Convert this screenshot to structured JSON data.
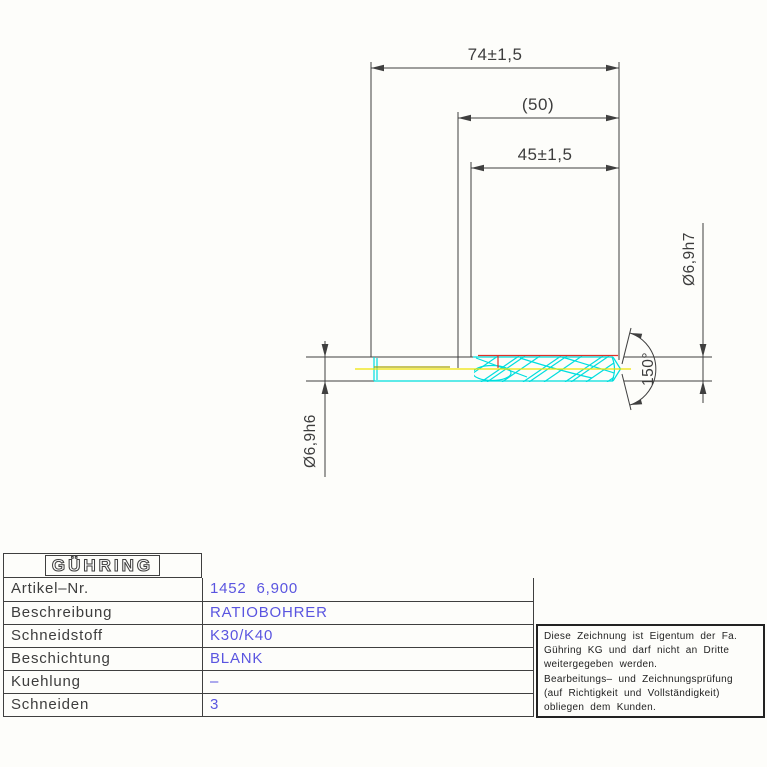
{
  "colors": {
    "background": "#fdfdfa",
    "line": "#3f3f3f",
    "label-text": "#3d3d3d",
    "value-text": "#5a55e0",
    "tool-outline": "#00dede",
    "centerline": "#f0e400",
    "coating": "#e03028",
    "core": "#a8a408"
  },
  "drawing": {
    "dims": {
      "overall_length": "74±1,5",
      "ref_length": "(50)",
      "flute_length": "45±1,5",
      "tip_diameter": "Ø6,9h7",
      "shank_diameter": "Ø6,9h6",
      "point_angle": "150°"
    }
  },
  "title_block": {
    "logo": "GÜHRING",
    "rows": [
      {
        "label": "Artikel–Nr.",
        "value": "1452  6,900"
      },
      {
        "label": "Beschreibung",
        "value": "RATIOBOHRER"
      },
      {
        "label": "Schneidstoff",
        "value": "K30/K40"
      },
      {
        "label": "Beschichtung",
        "value": "BLANK"
      },
      {
        "label": "Kuehlung",
        "value": "–"
      },
      {
        "label": "Schneiden",
        "value": "3"
      }
    ]
  },
  "disclaimer": {
    "lines": [
      "Diese Zeichnung ist Eigentum der Fa.",
      "Gühring KG und darf nicht an Dritte",
      "weitergegeben werden.",
      "Bearbeitungs– und Zeichnungsprüfung",
      "(auf Richtigkeit und Vollständigkeit)",
      "obliegen dem Kunden."
    ]
  }
}
